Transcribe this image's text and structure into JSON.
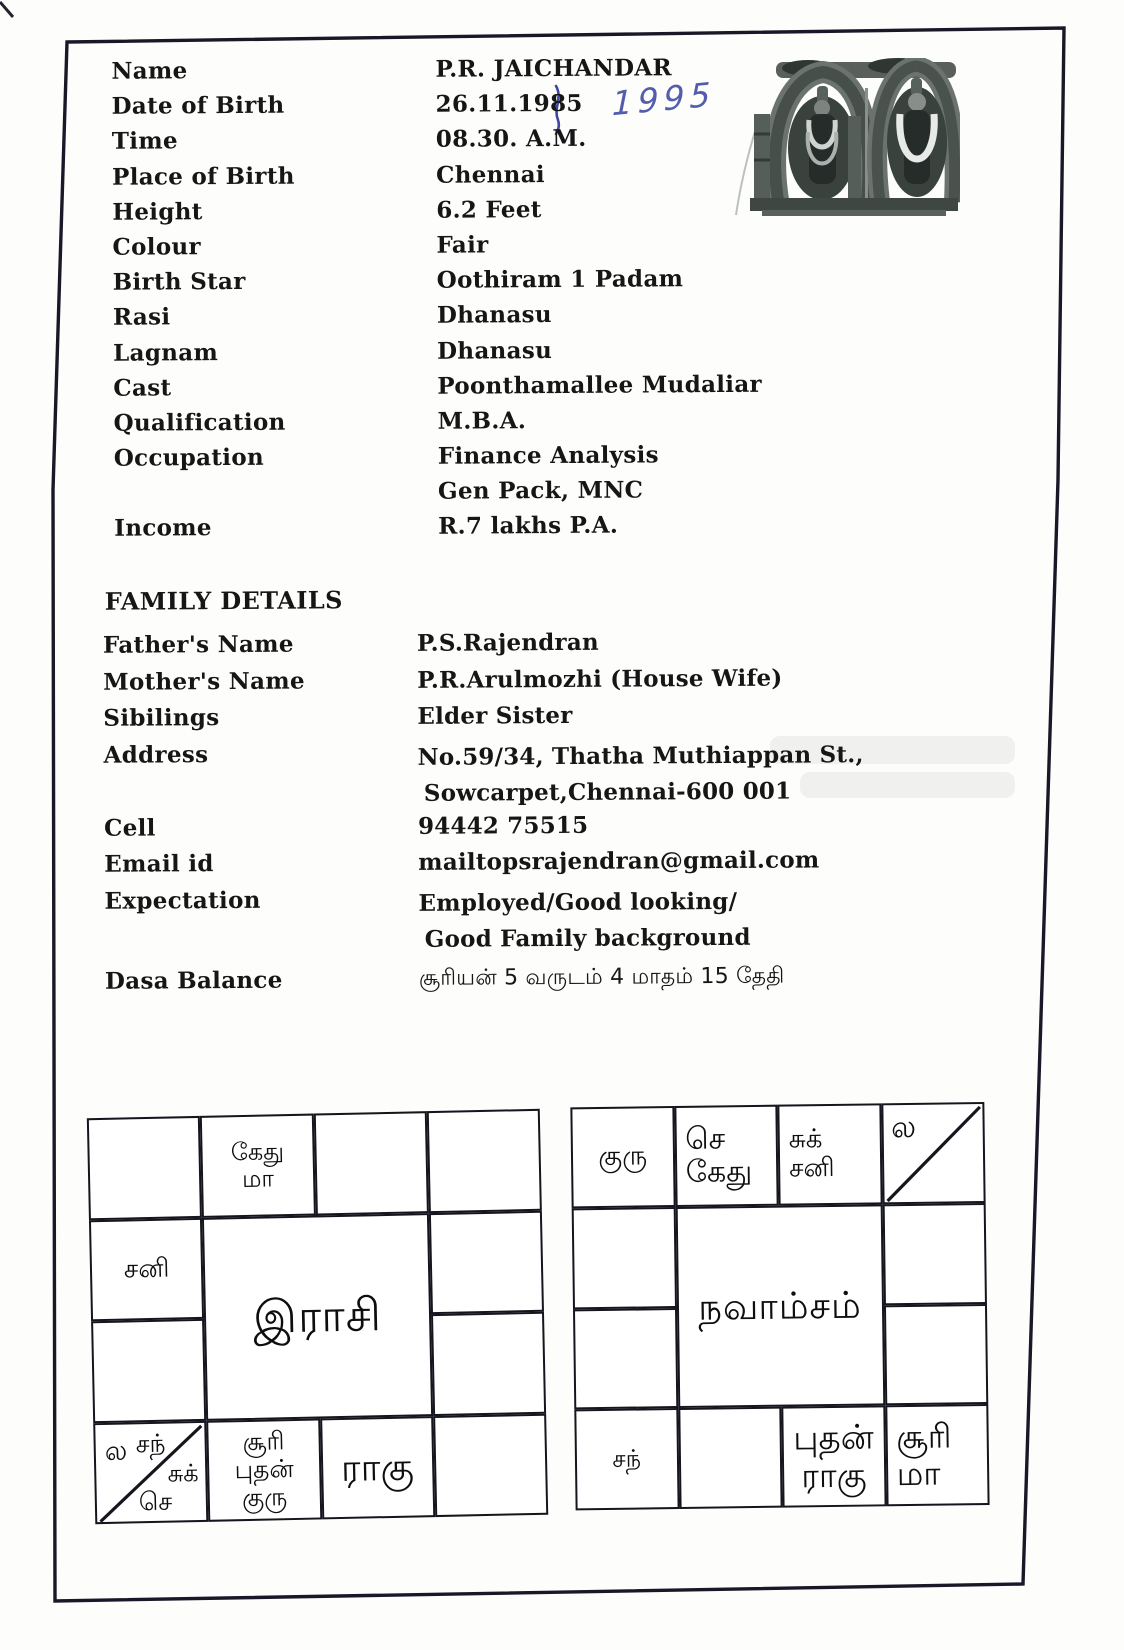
{
  "document": {
    "personal": {
      "rows": [
        {
          "label": "Name",
          "value": "P.R. JAICHANDAR"
        },
        {
          "label": "Date of Birth",
          "value": "26.11.1985"
        },
        {
          "label": "Time",
          "value": "08.30. A.M."
        },
        {
          "label": "Place of Birth",
          "value": "Chennai"
        },
        {
          "label": "Height",
          "value": "6.2 Feet"
        },
        {
          "label": "Colour",
          "value": "Fair"
        },
        {
          "label": "Birth Star",
          "value": "Oothiram 1 Padam"
        },
        {
          "label": "Rasi",
          "value": "Dhanasu"
        },
        {
          "label": "Lagnam",
          "value": "Dhanasu"
        },
        {
          "label": "Cast",
          "value": "Poonthamallee Mudaliar"
        },
        {
          "label": "Qualification",
          "value": "M.B.A."
        },
        {
          "label": "Occupation",
          "value": "Finance Analysis"
        },
        {
          "label": "",
          "value": "Gen Pack, MNC"
        },
        {
          "label": "Income",
          "value": "R.7 lakhs P.A."
        }
      ]
    },
    "handwritten": {
      "year_correction": "1995"
    },
    "family": {
      "heading": "FAMILY DETAILS",
      "father": {
        "label": "Father's Name",
        "value": "P.S.Rajendran"
      },
      "mother": {
        "label": "Mother's Name",
        "value": "P.R.Arulmozhi (House Wife)"
      },
      "siblings": {
        "label": "Sibilings",
        "value": "Elder Sister"
      },
      "address": {
        "label": "Address",
        "line1": "No.59/34, Thatha Muthiappan St.,",
        "line2": "Sowcarpet,Chennai-600 001"
      },
      "cell": {
        "label": "Cell",
        "value": "94442 75515"
      },
      "email": {
        "label": "Email id",
        "value": "mailtopsrajendran@gmail.com"
      },
      "expectation": {
        "label": "Expectation",
        "line1": "Employed/Good looking/",
        "line2": "Good Family background"
      },
      "dasa": {
        "label": "Dasa Balance",
        "value": "சூரியன் 5 வருடம் 4 மாதம் 15 தேதி"
      }
    },
    "rasi_chart": {
      "center": "இராசி",
      "cells": {
        "r1c1": "",
        "r1c2": "கேது\nமா",
        "r1c3": "",
        "r1c4": "",
        "r2c1": "சனி",
        "r2c4": "",
        "r3c1": "",
        "r3c4": "",
        "r4c1_tl": "ல",
        "r4c1_t2": "சந்",
        "r4c1_mr": "சுக்",
        "r4c1_b": "செ",
        "r4c2": "சூரி\nபுதன்\nகுரு",
        "r4c3": "ராகு",
        "r4c4": ""
      }
    },
    "navamsam_chart": {
      "center": "நவாம்சம்",
      "cells": {
        "r1c1": "குரு",
        "r1c2": "செ\n கேது",
        "r1c3": "சுக்\n சனி",
        "r1c4_tl": "ல",
        "r2c1": "",
        "r2c4": "",
        "r3c1": "",
        "r3c4": "",
        "r4c1": "சந்",
        "r4c2": "",
        "r4c3": "புதன்\nராகு",
        "r4c4": "சூரி\n  மா"
      }
    }
  }
}
